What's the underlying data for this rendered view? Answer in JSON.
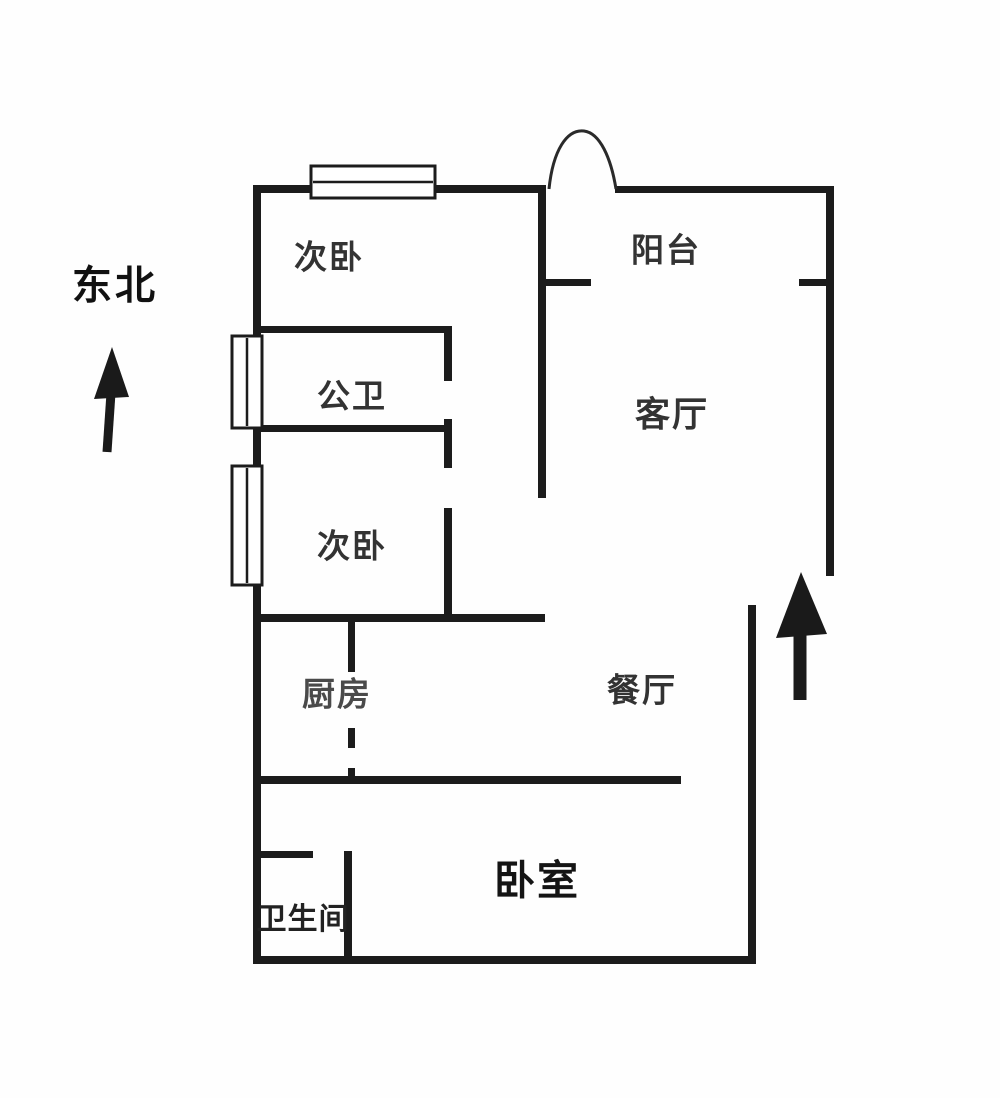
{
  "page": {
    "background": "#fefefe",
    "type_label": "floor-plan"
  },
  "floorplan": {
    "wall_color": "#1c1c1c",
    "text_color": "#333333",
    "accent_text_color": "#141414",
    "compass": {
      "label": "东北"
    },
    "rooms": [
      {
        "id": "bedroom-secondary-top",
        "label": "次卧"
      },
      {
        "id": "balcony",
        "label": "阳台"
      },
      {
        "id": "bathroom-public",
        "label": "公卫"
      },
      {
        "id": "living-room",
        "label": "客厅"
      },
      {
        "id": "bedroom-secondary-mid",
        "label": "次卧"
      },
      {
        "id": "kitchen",
        "label": "厨房"
      },
      {
        "id": "dining-room",
        "label": "餐厅"
      },
      {
        "id": "bedroom-master",
        "label": "卧室"
      },
      {
        "id": "bathroom",
        "label": "卫生间"
      }
    ],
    "walls": [
      {
        "name": "left-outer-wall",
        "x": 253,
        "y": 185,
        "w": 8,
        "h": 779
      },
      {
        "name": "top-wall-bedroom",
        "x": 253,
        "y": 185,
        "w": 293,
        "h": 8
      },
      {
        "name": "corridor-left-wall",
        "x": 538,
        "y": 185,
        "w": 8,
        "h": 313
      },
      {
        "name": "balcony-top-wall",
        "x": 615,
        "y": 186,
        "w": 218,
        "h": 7
      },
      {
        "name": "right-outer-wall",
        "x": 826,
        "y": 186,
        "w": 8,
        "h": 390
      },
      {
        "name": "balcony-divider-left",
        "x": 541,
        "y": 279,
        "w": 50,
        "h": 7
      },
      {
        "name": "balcony-divider-right",
        "x": 799,
        "y": 279,
        "w": 34,
        "h": 7
      },
      {
        "name": "bathroom-public-top",
        "x": 253,
        "y": 326,
        "w": 199,
        "h": 7
      },
      {
        "name": "bathroom-public-right-a",
        "x": 444,
        "y": 326,
        "w": 8,
        "h": 55
      },
      {
        "name": "bathroom-public-bottom",
        "x": 253,
        "y": 425,
        "w": 199,
        "h": 7
      },
      {
        "name": "bathroom-public-right-b",
        "x": 444,
        "y": 419,
        "w": 8,
        "h": 49
      },
      {
        "name": "bedroom-mid-right-wall",
        "x": 444,
        "y": 508,
        "w": 8,
        "h": 114
      },
      {
        "name": "bedroom-mid-bottom-wall",
        "x": 253,
        "y": 614,
        "w": 292,
        "h": 8
      },
      {
        "name": "kitchen-divider-a",
        "x": 348,
        "y": 622,
        "w": 7,
        "h": 50
      },
      {
        "name": "kitchen-divider-b",
        "x": 348,
        "y": 728,
        "w": 7,
        "h": 20
      },
      {
        "name": "kitchen-divider-c",
        "x": 348,
        "y": 768,
        "w": 7,
        "h": 14
      },
      {
        "name": "dining-bedroom-divider",
        "x": 253,
        "y": 776,
        "w": 428,
        "h": 8
      },
      {
        "name": "dining-right-wall",
        "x": 748,
        "y": 605,
        "w": 8,
        "h": 359
      },
      {
        "name": "bathroom-top-wall",
        "x": 257,
        "y": 851,
        "w": 56,
        "h": 7
      },
      {
        "name": "bathroom-right-wall",
        "x": 344,
        "y": 851,
        "w": 8,
        "h": 113
      },
      {
        "name": "bottom-outer-wall",
        "x": 253,
        "y": 956,
        "w": 503,
        "h": 8
      }
    ],
    "windows": [
      {
        "name": "window-top-bedroom",
        "x": 311,
        "y": 166,
        "w": 124,
        "h": 32
      },
      {
        "name": "window-left-upper",
        "x": 232,
        "y": 336,
        "w": 30,
        "h": 92
      },
      {
        "name": "window-left-lower",
        "x": 232,
        "y": 466,
        "w": 30,
        "h": 119
      }
    ],
    "door_arcs": [
      {
        "name": "balcony-door-arc",
        "path": "M 549 189 C 553 150 567 129 584 131 C 600 133 611 158 616 189"
      }
    ],
    "arrows": [
      {
        "name": "compass-arrow",
        "head": "112,347 129,397 94,399",
        "shaft": {
          "x1": 107,
          "y1": 452,
          "x2": 111,
          "y2": 393,
          "w": 9
        }
      },
      {
        "name": "entrance-arrow",
        "head": "801,572 827,634 776,638",
        "shaft": {
          "x1": 800,
          "y1": 700,
          "x2": 800,
          "y2": 634,
          "w": 13
        }
      }
    ]
  }
}
